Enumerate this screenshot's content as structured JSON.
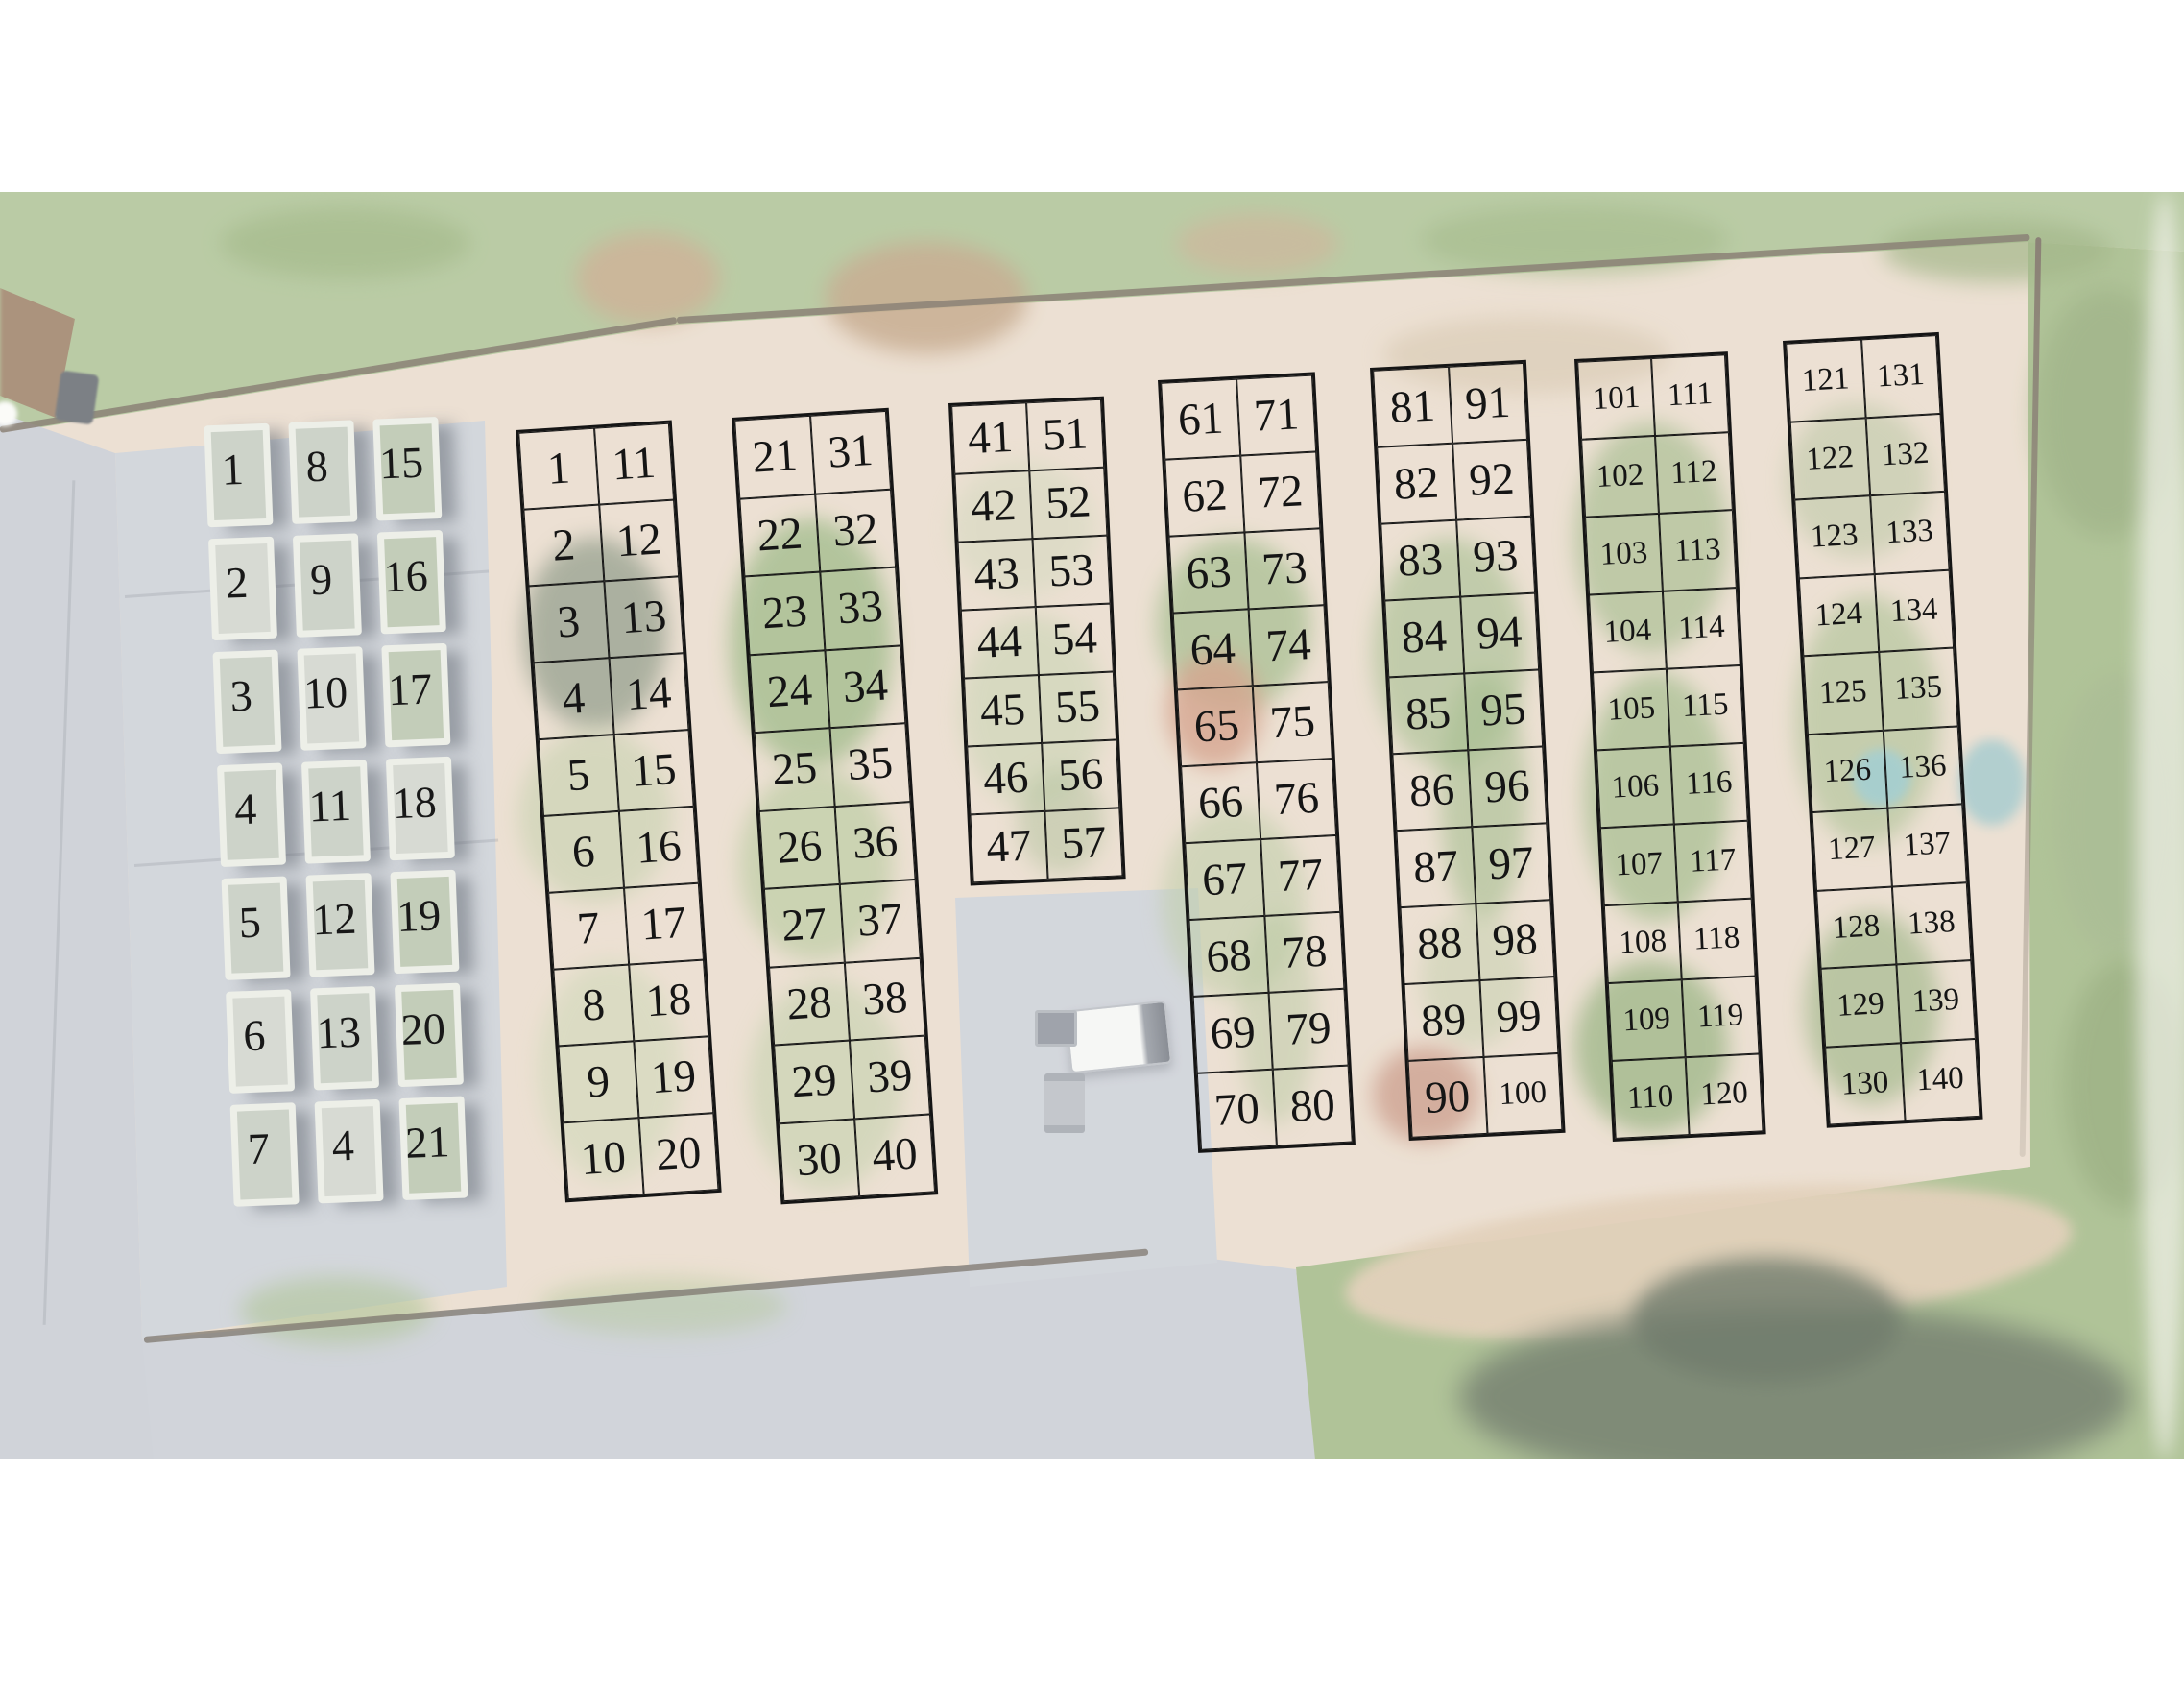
{
  "colors": {
    "grid_line": "#151515",
    "number_text": "#181818",
    "bed_frame": "#edefe8",
    "road_gray": "#c6cad1",
    "pad_gray": "#c9cdd4",
    "field_dirt": "#e8d9c8",
    "grass_green": "#a9bf8f",
    "trees_dark": "#5a6852",
    "fence_brown": "#6f6355",
    "tarp_teal": "#8fc3c6"
  },
  "raised_beds": {
    "cells": [
      "1",
      "8",
      "15",
      "2",
      "9",
      "16",
      "3",
      "10",
      "17",
      "4",
      "11",
      "18",
      "5",
      "12",
      "19",
      "6",
      "13",
      "20",
      "7",
      "4",
      "21"
    ]
  },
  "plot_grids": [
    {
      "id": "grid-1-20",
      "cells": [
        "1",
        "11",
        "2",
        "12",
        "3",
        "13",
        "4",
        "14",
        "5",
        "15",
        "6",
        "16",
        "7",
        "17",
        "8",
        "18",
        "9",
        "19",
        "10",
        "20"
      ]
    },
    {
      "id": "grid-21-40",
      "cells": [
        "21",
        "31",
        "22",
        "32",
        "23",
        "33",
        "24",
        "34",
        "25",
        "35",
        "26",
        "36",
        "27",
        "37",
        "28",
        "38",
        "29",
        "39",
        "30",
        "40"
      ]
    },
    {
      "id": "grid-41-57",
      "cells": [
        "41",
        "51",
        "42",
        "52",
        "43",
        "53",
        "44",
        "54",
        "45",
        "55",
        "46",
        "56",
        "47",
        "57"
      ]
    },
    {
      "id": "grid-61-80",
      "cells": [
        "61",
        "71",
        "62",
        "72",
        "63",
        "73",
        "64",
        "74",
        "65",
        "75",
        "66",
        "76",
        "67",
        "77",
        "68",
        "78",
        "69",
        "79",
        "70",
        "80"
      ]
    },
    {
      "id": "grid-81-100",
      "cells": [
        "81",
        "91",
        "82",
        "92",
        "83",
        "93",
        "84",
        "94",
        "85",
        "95",
        "86",
        "96",
        "87",
        "97",
        "88",
        "98",
        "89",
        "99",
        "90",
        "100"
      ]
    },
    {
      "id": "grid-101-120",
      "cells": [
        "101",
        "111",
        "102",
        "112",
        "103",
        "113",
        "104",
        "114",
        "105",
        "115",
        "106",
        "116",
        "107",
        "117",
        "108",
        "118",
        "109",
        "119",
        "110",
        "120"
      ]
    },
    {
      "id": "grid-121-140",
      "cells": [
        "121",
        "131",
        "122",
        "132",
        "123",
        "133",
        "124",
        "134",
        "125",
        "135",
        "126",
        "136",
        "127",
        "137",
        "128",
        "138",
        "129",
        "139",
        "130",
        "140"
      ]
    }
  ]
}
